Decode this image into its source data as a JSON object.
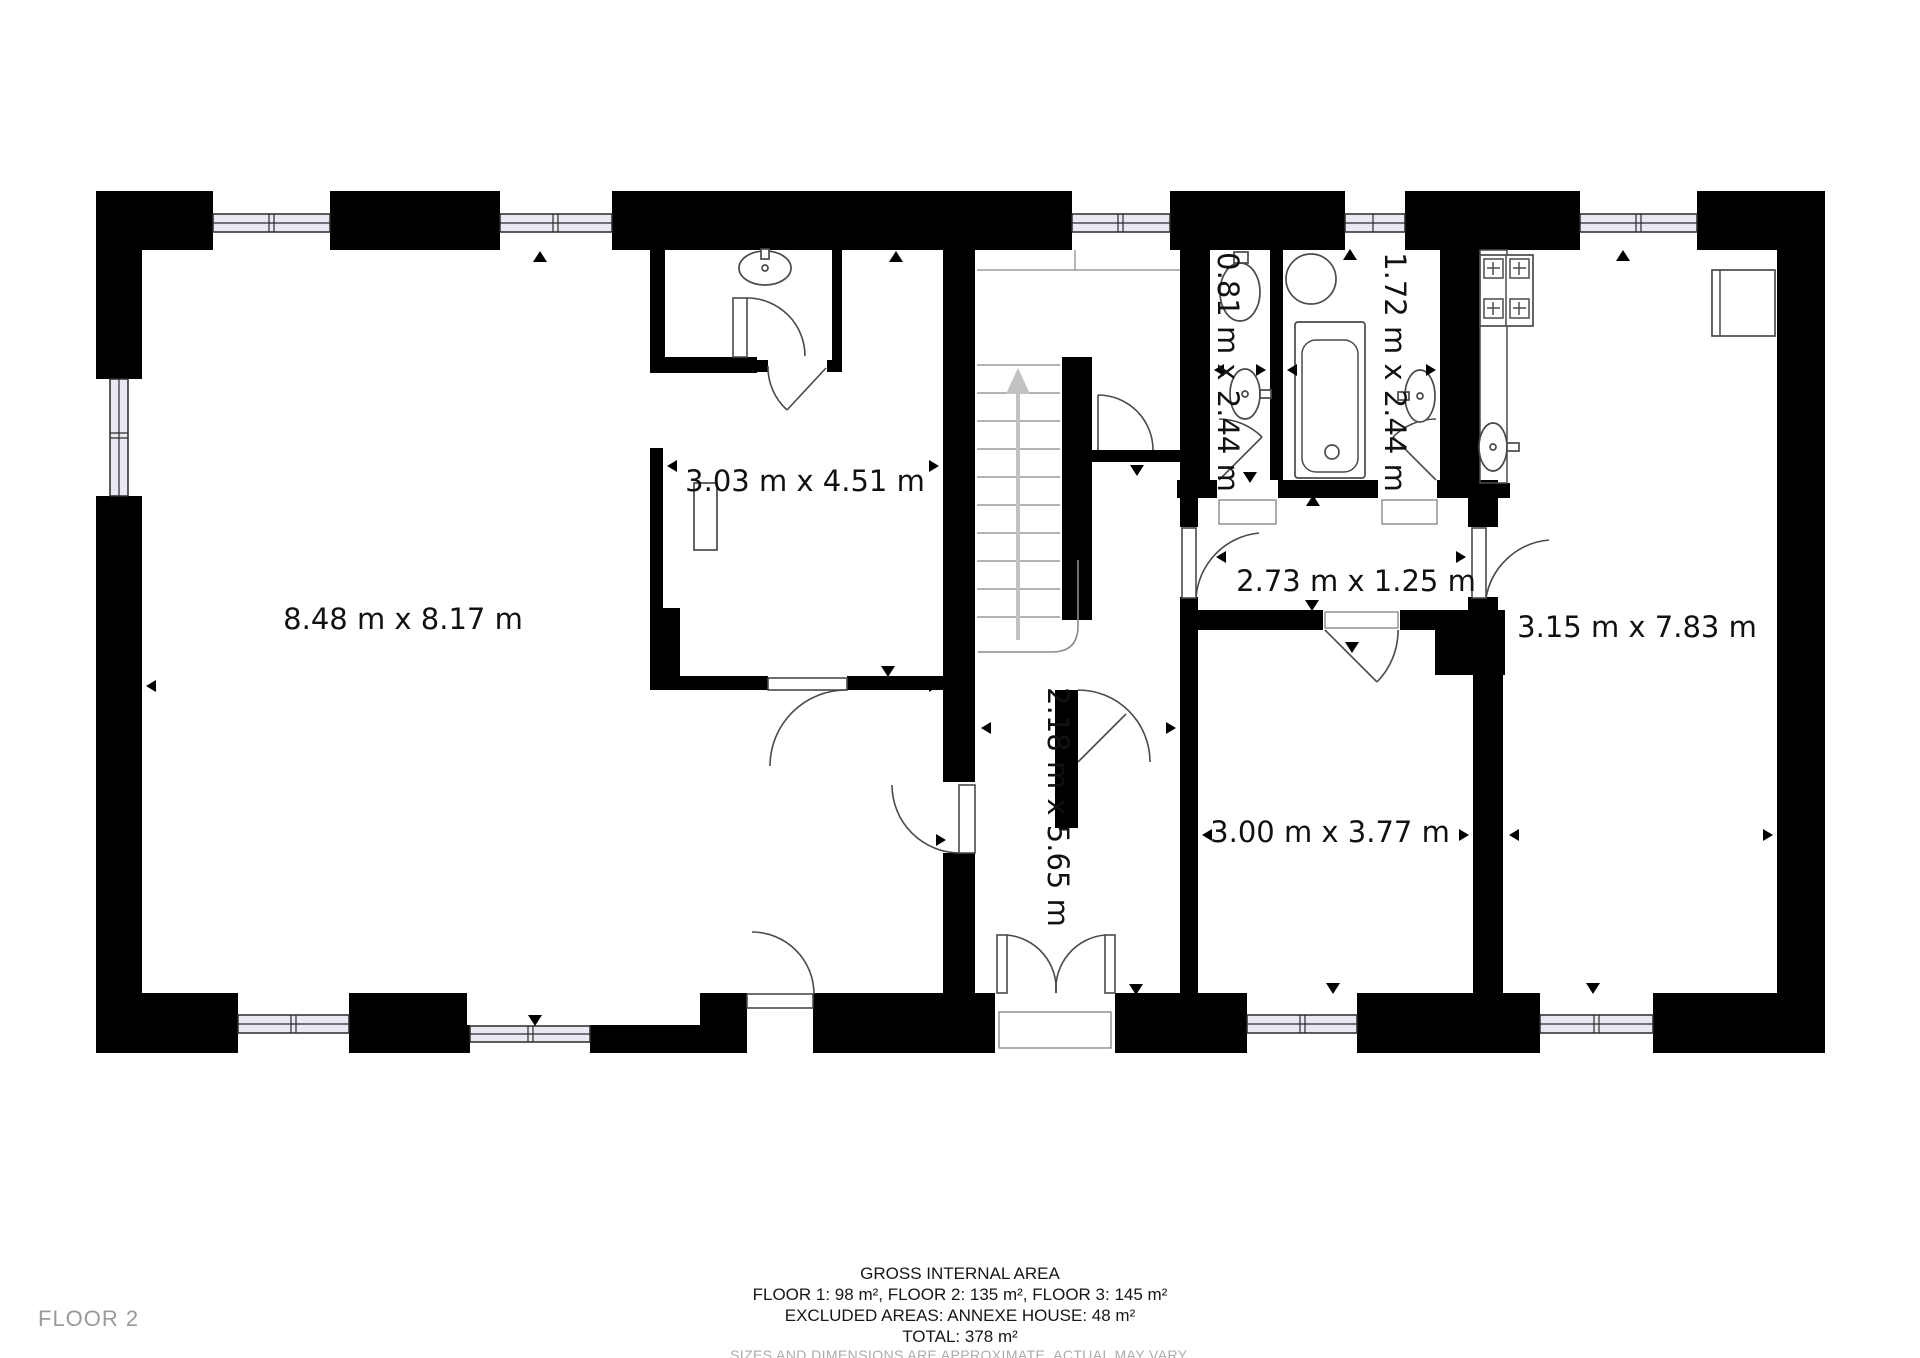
{
  "plan": {
    "floor_label": "FLOOR 2",
    "rooms": [
      {
        "name": "living-room",
        "label": "8.48 m x 8.17 m"
      },
      {
        "name": "upper-room",
        "label": "3.03 m x 4.51 m"
      },
      {
        "name": "stair-hall",
        "label": "2.18 m x 5.65 m"
      },
      {
        "name": "wc",
        "label": "0.81 m x 2.44 m"
      },
      {
        "name": "bathroom",
        "label": "1.72 m x 2.44 m"
      },
      {
        "name": "hallway",
        "label": "2.73 m x 1.25 m"
      },
      {
        "name": "bedroom",
        "label": "3.00 m x 3.77 m"
      },
      {
        "name": "kitchen-living",
        "label": "3.15 m x 7.83 m"
      }
    ],
    "fixtures": [
      "stairs-up-icon",
      "toilet-icon",
      "sink-icon",
      "bathtub-icon",
      "shower-icon",
      "stove-icon",
      "counter",
      "desk",
      "dresser"
    ]
  },
  "footer": {
    "title": "GROSS INTERNAL AREA",
    "floors": "FLOOR 1: 98 m², FLOOR 2: 135 m², FLOOR 3: 145 m²",
    "excluded": "EXCLUDED AREAS: ANNEXE HOUSE: 48 m²",
    "total": "TOTAL: 378 m²",
    "disclaimer": "SIZES AND DIMENSIONS ARE APPROXIMATE, ACTUAL MAY VARY."
  },
  "colors": {
    "wall": "#000000",
    "window_pane": "#e9e9f4",
    "fixture_stroke": "#4a4a4a",
    "stair_arrow": "#c2c2c2",
    "muted_text": "#a6a6a6"
  }
}
